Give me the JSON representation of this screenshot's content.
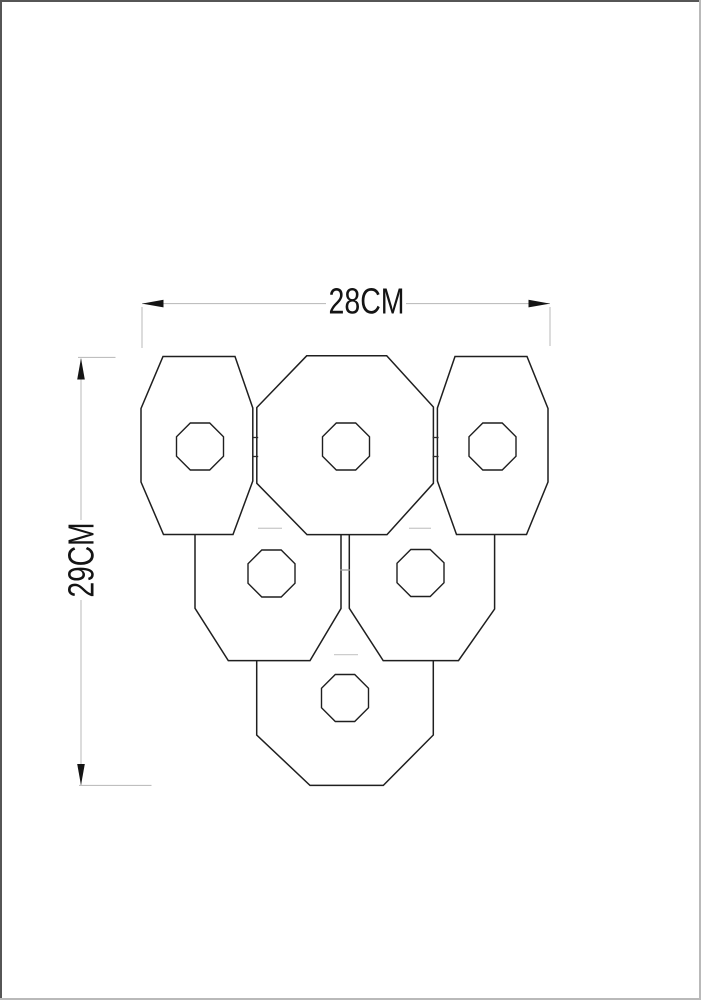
{
  "drawing": {
    "kind": "product-dimension-diagram",
    "object": "six-octagonal-plate-fixture",
    "width_label": "28CM",
    "height_label": "29CM"
  },
  "colors": {
    "background": "#ffffff",
    "outline": "#1f1f1f",
    "dim_line": "#bfbfbf",
    "text": "#141414",
    "arrow": "#141414",
    "hidden_line": "#cdcdcd",
    "hinge_tick": "#2a2a2a",
    "border_dark": "#565656",
    "border_light": "#b9b9b9"
  }
}
